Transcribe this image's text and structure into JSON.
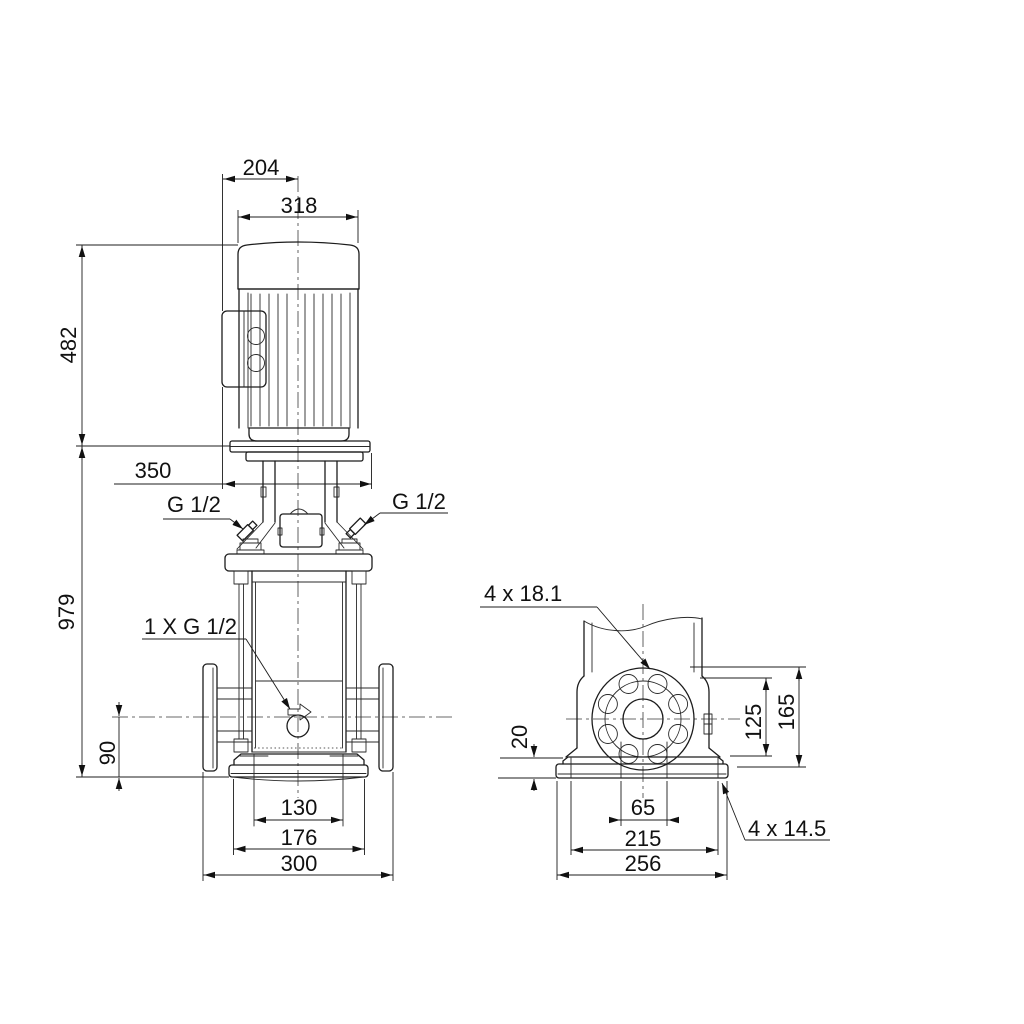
{
  "drawing": {
    "background": "#ffffff",
    "line_color": "#1c1c1c",
    "type": "pump dimensional drawing"
  },
  "front_view": {
    "dimensions": {
      "motor_depth": "204",
      "motor_width": "318",
      "motor_height": "482",
      "total_height": "979",
      "depth_overall": "350",
      "port_center_to_base": "90",
      "base_width_inner": "130",
      "base_width_mid": "176",
      "flange_to_flange": "300"
    },
    "labels": {
      "plug_left": "G 1/2",
      "plug_right": "G 1/2",
      "drain_plug": "1 X G 1/2"
    }
  },
  "side_view": {
    "dimensions": {
      "base_step_height": "20",
      "flange_height_inner": "125",
      "flange_height_outer": "165",
      "base_hole_spacing_inner": "65",
      "base_hole_spacing": "215",
      "base_plate_width": "256"
    },
    "labels": {
      "flange_bolt_holes": "4 x 18.1",
      "base_bolt_holes": "4 x 14.5"
    }
  }
}
